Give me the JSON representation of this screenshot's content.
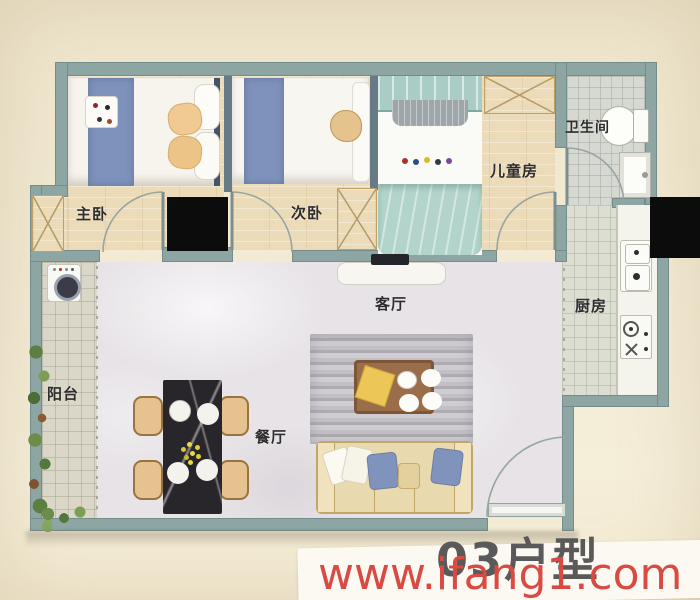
{
  "floorplan": {
    "unit_title": "03户型",
    "rooms": {
      "master_bedroom": "主卧",
      "second_bedroom": "次卧",
      "kids_room": "儿童房",
      "bathroom": "卫生间",
      "kitchen": "厨房",
      "living_room": "客厅",
      "dining_room": "餐厅",
      "balcony": "阳台"
    }
  },
  "watermark": {
    "url_text": "www.ifang1.com"
  },
  "colors": {
    "wall": "#8da5a3",
    "wood_floor": "#ecdbb8",
    "bed_blue": "#7e92bc",
    "kids_teal": "#b2d4cb",
    "watermark_red": "#d84a42",
    "title_gray": "#5a5a5a"
  }
}
